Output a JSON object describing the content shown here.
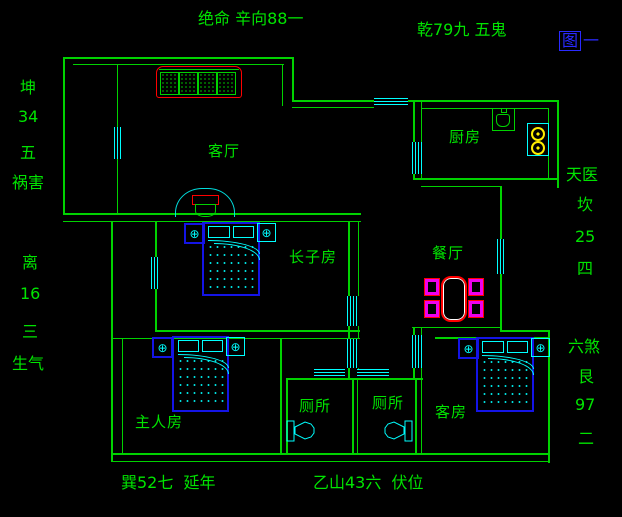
{
  "figure": {
    "boxed_char": "图",
    "suffix": "一"
  },
  "annotations": {
    "top_center": "绝命 辛向88一",
    "top_right": "乾79九 五鬼",
    "bottom_left": "巽52七  延年",
    "bottom_center": "乙山43六  伏位",
    "left_upper": {
      "trigram": "坤",
      "numbers": "34",
      "rank": "五",
      "star": "祸害"
    },
    "left_lower": {
      "trigram": "离",
      "numbers": "16",
      "rank": "三",
      "star": "生气"
    },
    "right_upper": {
      "star": "天医",
      "trigram": "坎",
      "numbers": "25",
      "rank": "四"
    },
    "right_lower": {
      "star": "六煞",
      "trigram": "艮",
      "numbers": "97",
      "rank": "二"
    }
  },
  "rooms": {
    "living_room": "客厅",
    "kitchen": "厨房",
    "dining_room": "餐厅",
    "eldest_son_room": "长子房",
    "master_room": "主人房",
    "toilet_left": "厕所",
    "toilet_right": "厕所",
    "guest_room": "客房"
  },
  "colors": {
    "background": "#000000",
    "wall_green": "#00d200",
    "text_green": "#00e400",
    "window_cyan": "#00ffff",
    "furniture_blue": "#1414e6",
    "accent_red": "#ff0000",
    "chair_magenta": "#ee00ee",
    "burner_yellow": "#ffee00",
    "figure_blue": "#2a2aff"
  }
}
